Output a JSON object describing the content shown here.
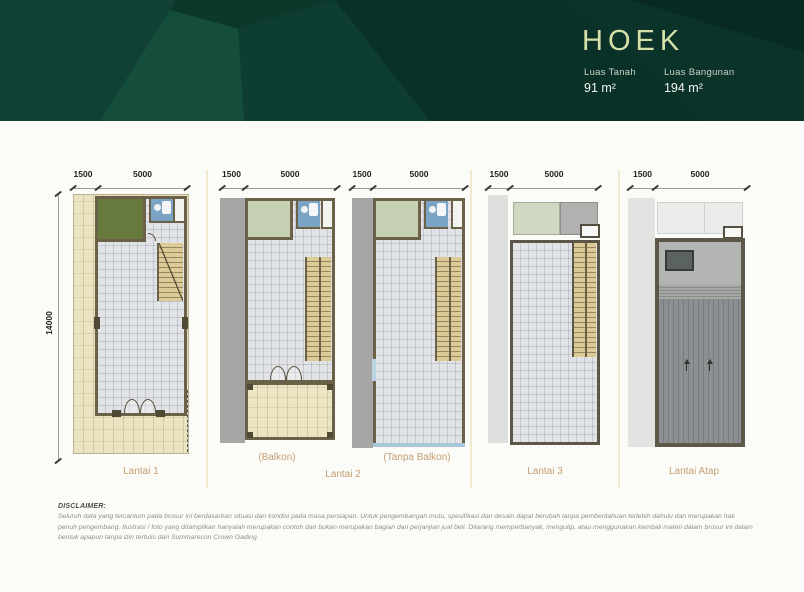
{
  "header": {
    "title": "HOEK",
    "stats": [
      {
        "label": "Luas Tanah",
        "value": "91 m²"
      },
      {
        "label": "Luas Bangunan",
        "value": "194 m²"
      }
    ]
  },
  "plans": [
    {
      "label": "Lantai 1",
      "dim_left": "1500",
      "dim_right": "5000",
      "dim_height": "14000"
    },
    {
      "label": "(Balkon)",
      "dim_left": "1500",
      "dim_right": "5000"
    },
    {
      "label": "(Tanpa Balkon)",
      "dim_left": "1500",
      "dim_right": "5000"
    },
    {
      "label": "Lantai 3",
      "dim_left": "1500",
      "dim_right": "5000"
    },
    {
      "label": "Lantai Atap",
      "dim_left": "1500",
      "dim_right": "5000"
    }
  ],
  "floor2_group_label": "Lantai 2",
  "disclaimer": {
    "heading": "DISCLAIMER:",
    "body": "Seluruh data yang tercantum pada brosur ini berdasarkan situasi dan kondisi pada masa persiapan. Untuk pengembangan mutu, spesifikasi dan desain dapat berubah tanpa pemberitahuan terlebih dahulu dan merupakan hak penuh pengembang. Ilustrasi / foto yang ditampilkan hanyalah merupakan contoh dan bukan merupakan bagian dari perjanjian jual beli. Dilarang memperbanyak, mengutip, atau menggunakan kembali materi dalam brosur ini dalam bentuk apapun tanpa izin tertulis dari Summarecon Crown Gading."
  },
  "colors": {
    "header_green": "#0C382C",
    "title_gold_green": "#D6E0A8",
    "label_gold": "#C59E73",
    "wall_olive": "#6B6149",
    "garden_green": "#68793E",
    "pale_green": "#C6D1B3",
    "bath_blue": "#7BA3C4",
    "yard_cream": "#EBE4C2",
    "stair_tan": "#DCCB97",
    "tile_grey": "#E1E3E6"
  }
}
